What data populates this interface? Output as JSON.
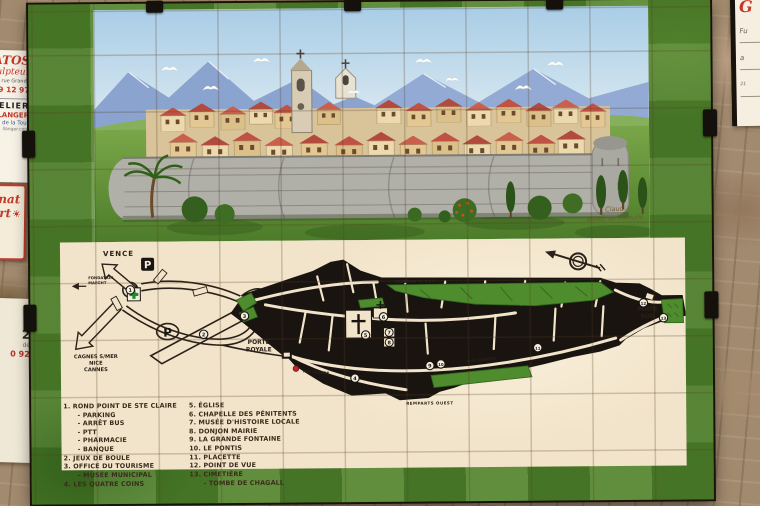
{
  "wall_signs": {
    "left_top": {
      "line1": "TRATOS",
      "line2": "Sculpteur",
      "line3": "rue Grande",
      "line4": "39 12 97",
      "line5": "ELIER",
      "line6": "NE MOLLANGER",
      "line7": "de la Tour",
      "line8": "llanger.com"
    },
    "left_mid": {
      "line1": "anat",
      "line2": "rt"
    },
    "left_bottom": {
      "line1": "2",
      "line2": "de",
      "line3": "0 92"
    },
    "top_right": {
      "line1": "G",
      "line2": "Fu",
      "line3": "a",
      "line4": "21"
    }
  },
  "painting": {
    "signature_line1": "Claud",
    "signature_line2": "Atelier de Vallauris"
  },
  "map": {
    "labels": {
      "vence": "VENCE",
      "fondation_line1": "FONDATION",
      "fondation_line2": "MAEGHT",
      "cagnes": "CAGNES S/MER",
      "nice": "NICE",
      "cannes": "CANNES",
      "porte_royale_line1": "PORTE",
      "porte_royale_line2": "ROYALE",
      "porte_sud_line1": "PORTE",
      "porte_sud_line2": "SUD",
      "remparts_est": "REMPARTS EST",
      "remparts_ouest": "REMPARTS OUEST",
      "rue_grande": "RUE GRANDE",
      "rue_grande_2": "RUE GRANDE",
      "parking_p1": "P",
      "parking_p2": "P"
    },
    "markers": [
      "1",
      "2",
      "3",
      "4",
      "5",
      "6",
      "7",
      "8",
      "9",
      "10",
      "11",
      "12",
      "13"
    ],
    "legend_left": [
      "1. ROND POINT DE STE CLAIRE",
      "      - PARKING",
      "      - ARRÊT BUS",
      "      - PTT",
      "      - PHARMACIE",
      "      - BANQUE",
      "2. JEUX DE BOULE",
      "3. OFFICE DU TOURISME",
      "      - MUSÉE MUNICIPAL",
      "4. LES QUATRE COINS"
    ],
    "legend_right": [
      "5. ÉGLISE",
      "6. CHAPELLE DES PÉNITENTS",
      "7. MUSÉE D'HISTOIRE LOCALE",
      "8. DONJON MAIRIE",
      "9. LA GRANDE FONTAINE",
      "10. LE PONTIS",
      "11. PLACETTE",
      "12. POINT DE VUE",
      "13. CIMETIÈRE",
      "      - TOMBE DE CHAGALL"
    ]
  }
}
